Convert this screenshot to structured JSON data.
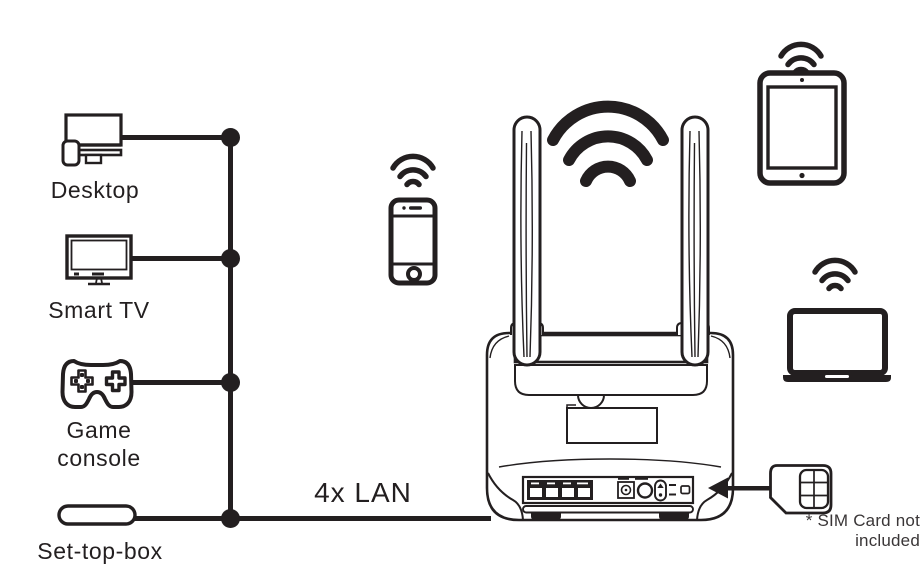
{
  "diagram": {
    "wired_devices": [
      {
        "name": "desktop",
        "label": "Desktop"
      },
      {
        "name": "smart-tv",
        "label": "Smart TV"
      },
      {
        "name": "game-console",
        "label": "Game console"
      },
      {
        "name": "set-top-box",
        "label": "Set-top-box"
      }
    ],
    "connection_label": "4x LAN",
    "router": {
      "antennas": 2,
      "lan_ports": 4
    },
    "wireless_devices": [
      {
        "name": "smartphone"
      },
      {
        "name": "tablet"
      },
      {
        "name": "laptop"
      }
    ],
    "sim_footnote": "* SIM Card not included"
  },
  "colors": {
    "ink": "#231f20",
    "background": "#ffffff",
    "sim_chip_fill": "#d9d9d9"
  }
}
